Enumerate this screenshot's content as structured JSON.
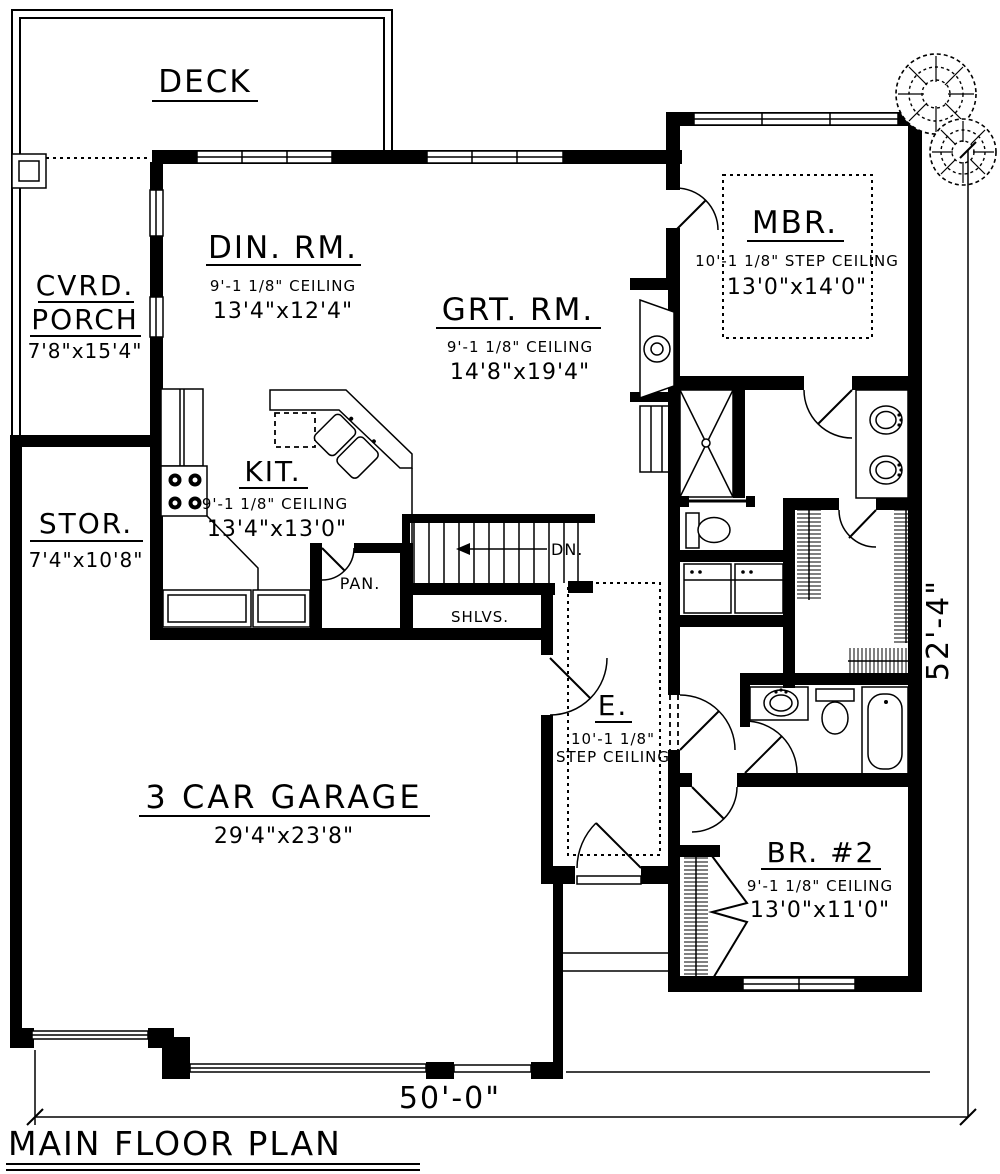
{
  "plan": {
    "title": "MAIN FLOOR PLAN",
    "overall_width": "50'-0\"",
    "overall_depth": "52'-4\"",
    "rooms": {
      "deck": {
        "name": "DECK"
      },
      "porch": {
        "name_line1": "CVRD.",
        "name_line2": "PORCH",
        "size": "7'8\"x15'4\""
      },
      "dining": {
        "name": "DIN. RM.",
        "ceiling": "9'-1 1/8\" CEILING",
        "size": "13'4\"x12'4\""
      },
      "great_room": {
        "name": "GRT. RM.",
        "ceiling": "9'-1 1/8\" CEILING",
        "size": "14'8\"x19'4\""
      },
      "master_bedroom": {
        "name": "MBR.",
        "ceiling": "10'-1 1/8\" STEP CEILING",
        "size": "13'0\"x14'0\""
      },
      "kitchen": {
        "name": "KIT.",
        "ceiling": "9'-1 1/8\" CEILING",
        "size": "13'4\"x13'0\""
      },
      "storage": {
        "name": "STOR.",
        "size": "7'4\"x10'8\""
      },
      "garage": {
        "name": "3 CAR GARAGE",
        "size": "29'4\"x23'8\""
      },
      "entry": {
        "name": "E.",
        "ceiling_height": "10'-1 1/8\"",
        "ceiling_type": "STEP CEILING"
      },
      "bedroom2": {
        "name": "BR. #2",
        "ceiling": "9'-1 1/8\" CEILING",
        "size": "13'0\"x11'0\""
      },
      "pantry": {
        "name": "PAN."
      },
      "shelves": {
        "name": "SHLVS."
      },
      "stairs": {
        "down_label": "DN."
      }
    },
    "colors": {
      "ink": "#000000",
      "paper": "#ffffff"
    }
  }
}
